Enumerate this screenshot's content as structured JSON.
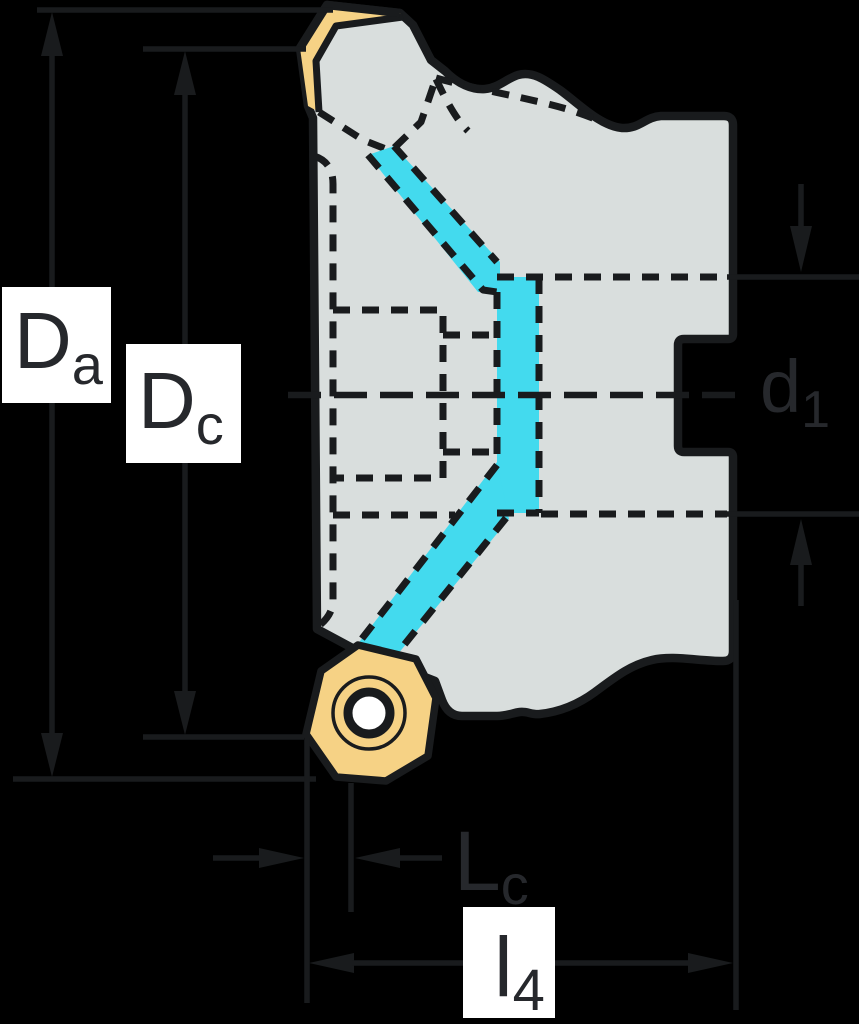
{
  "diagram": {
    "kind": "technical-drawing",
    "subject": "face-milling-cutter-cross-section"
  },
  "colors": {
    "background": "#000000",
    "body_fill": "#D9DEDD",
    "insert_fill": "#F6D285",
    "coolant_fill": "#43DAEE",
    "line": "#191B1D",
    "label_box": "#FFFFFF",
    "label_text": "#26282C"
  },
  "dimensions": [
    {
      "id": "Da",
      "main": "D",
      "sub": "a",
      "meaning": "outer-diameter"
    },
    {
      "id": "Dc",
      "main": "D",
      "sub": "c",
      "meaning": "cutting-diameter"
    },
    {
      "id": "d1",
      "main": "d",
      "sub": "1",
      "meaning": "bore-diameter"
    },
    {
      "id": "Lc",
      "main": "L",
      "sub": "c",
      "meaning": "cutting-edge-length"
    },
    {
      "id": "l4",
      "main": "l",
      "sub": "4",
      "meaning": "overall-length"
    }
  ]
}
